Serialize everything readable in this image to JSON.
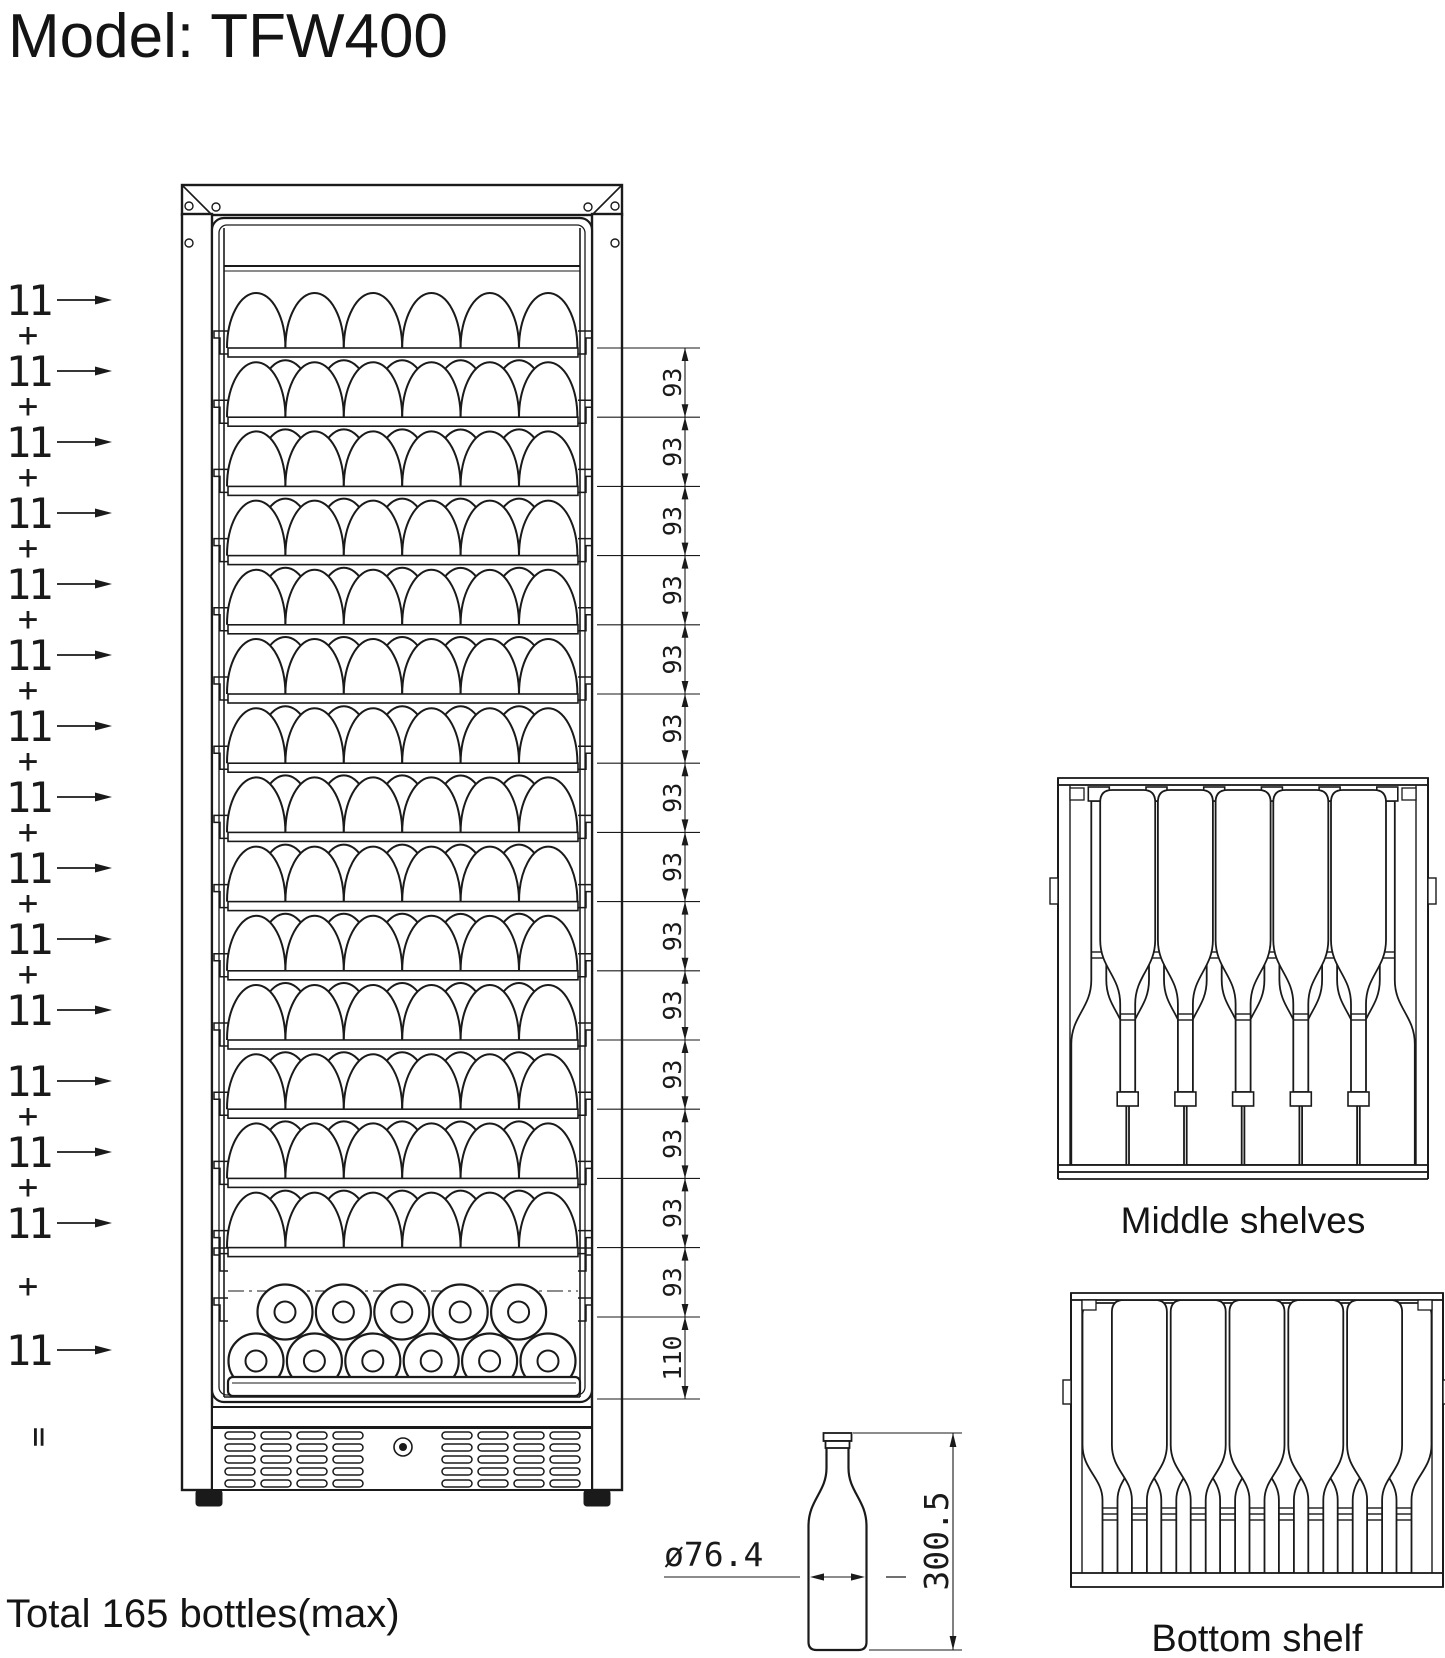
{
  "title": "Model: TFW400",
  "summary": {
    "total": "Total 165 bottles(max)",
    "equals": "="
  },
  "left_column": {
    "bottle_count": "11",
    "plus": "+",
    "rows": 15,
    "plus_missing_after_row": 11
  },
  "dimensions": {
    "shelf_spacing": "93",
    "shelf_spacing_count": 14,
    "bottom_section_height": "110",
    "bottle_diameter": "ø76.4",
    "bottle_height": "300.5"
  },
  "front_view": {
    "shelf_rows": 14,
    "front_bottles_per_row": 6,
    "rear_bottles_per_row": 5,
    "standing_row_top": 5,
    "standing_row_bottom": 6
  },
  "details": {
    "middle": {
      "label": "Middle shelves",
      "inverted_bottles": 5,
      "upright_bottles": 6
    },
    "bottom": {
      "label": "Bottom shelf",
      "bottles": 11
    }
  },
  "colors": {
    "line": "#1a1a1a",
    "background": "#ffffff"
  }
}
